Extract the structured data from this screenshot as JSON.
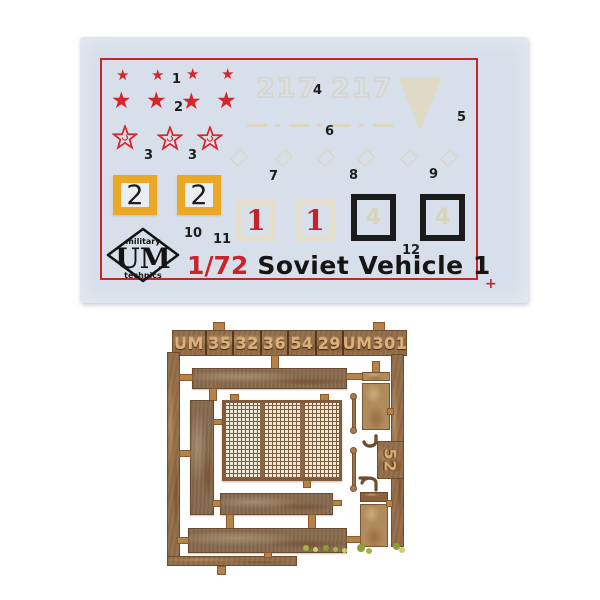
{
  "photo": {
    "background_color": "#ffffff",
    "subject": "model kit decal sheet and photo-etched brass fret"
  },
  "decal_sheet": {
    "sheet_color": "#d7e0ea",
    "border_color": "#c9242c",
    "star_glyph": "★",
    "star_color": "#d6252c",
    "labels": {
      "n1": "1",
      "n2": "2",
      "n3a": "3",
      "n3b": "3",
      "n4": "4",
      "n5": "5",
      "n6": "6",
      "n7": "7",
      "n8": "8",
      "n9": "9",
      "n10": "10",
      "n11": "11",
      "n12": "12"
    },
    "faint_code_left": "217",
    "faint_code_right": "217",
    "yellow_square_digit": "2",
    "white_square_digit": "1",
    "black_square_faint_digit": "4",
    "logo": {
      "top": "military",
      "main": "UM",
      "bottom": "technics"
    },
    "scale": "1/72",
    "title": "Soviet Vehicle 1",
    "registration_mark": "+",
    "colors": {
      "yellow": "#e9a826",
      "faint_cream": "#ddd8c2",
      "black": "#1b1b1b",
      "red_digit": "#c5232b"
    }
  },
  "etch_fret": {
    "brass_color": "#95714d",
    "banner_segments": [
      "UM",
      "35",
      "32",
      "36",
      "54",
      "29",
      "UM301"
    ],
    "side_code": "52"
  }
}
